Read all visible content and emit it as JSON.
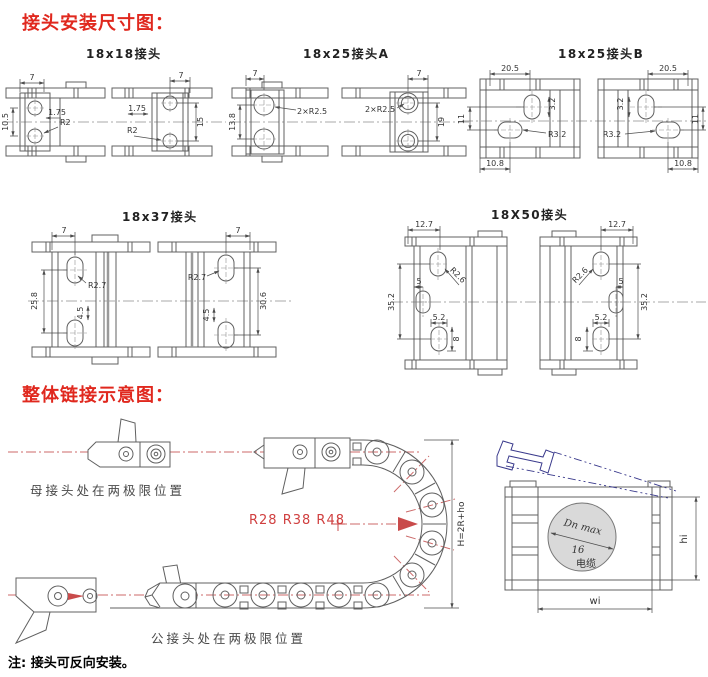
{
  "page": {
    "heading1": "接头安装尺寸图：",
    "heading2": "整体链接示意图：",
    "note": "注: 接头可反向安装。"
  },
  "colors": {
    "heading_red": "#e0281e",
    "line_gray": "#606060",
    "centerline_red": "#cc6a6a",
    "arrow_red": "#c94b4b",
    "blue_outline": "#3a3a8c",
    "cable_circle_fill": "#d9d9d9"
  },
  "drawings": {
    "d18x18": {
      "title": "18x18接头",
      "dim_top": "7",
      "dim_left": "10.5",
      "dim_offset": "1.75",
      "dim_radius": "R2",
      "dim_right": "15"
    },
    "d18x25a": {
      "title": "18x25接头A",
      "dim_top": "7",
      "dim_left": "13.8",
      "dim_radius": "2×R2.5",
      "dim_right": "19"
    },
    "d18x25b": {
      "title": "18x25接头B",
      "dim_top": "20.5",
      "dim_slot": "3.2",
      "dim_side": "11",
      "dim_radius": "R3.2",
      "dim_bottom": "10.8"
    },
    "d18x37": {
      "title": "18x37接头",
      "dim_top": "7",
      "dim_radius": "R2.7",
      "dim_left": "25.8",
      "dim_slot": "4.5",
      "dim_right": "30.6"
    },
    "d18x50": {
      "title": "18X50接头",
      "dim_top": "12.7",
      "dim_radius": "R2.6",
      "dim_offset": "5",
      "dim_side": "35.2",
      "dim_slot_w": "5.2",
      "dim_slot_h": "8"
    }
  },
  "assembly": {
    "female_label": "母接头处在两极限位置",
    "male_label": "公接头处在两极限位置",
    "radius_label": "R28  R38  R48",
    "height_formula": "H=2R+ho",
    "section": {
      "line1": "Dn max",
      "line2": "16",
      "line3": "电缆",
      "dim_height": "hi",
      "dim_width": "wi"
    }
  }
}
